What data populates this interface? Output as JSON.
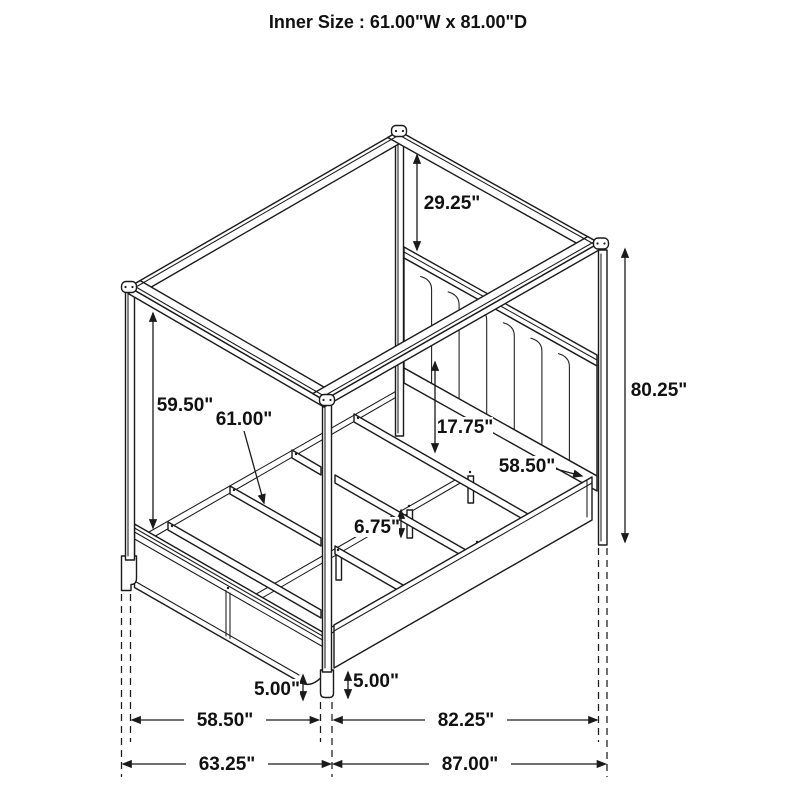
{
  "title": "Inner Size : 61.00\"W x 81.00\"D",
  "dims": {
    "canopy_to_headboard": "29.25\"",
    "overall_height": "80.25\"",
    "post_height": "59.50\"",
    "inner_slat_width": "61.00\"",
    "rail_to_headboard": "17.75\"",
    "headboard_width": "58.50\"",
    "support_leg_height": "6.75\"",
    "footboard_floor_clearance": "5.00\"",
    "siderail_floor_clearance": "5.00\"",
    "footboard_width": "58.50\"",
    "siderail_length": "82.25\"",
    "overall_width": "63.25\"",
    "overall_depth": "87.00\""
  }
}
